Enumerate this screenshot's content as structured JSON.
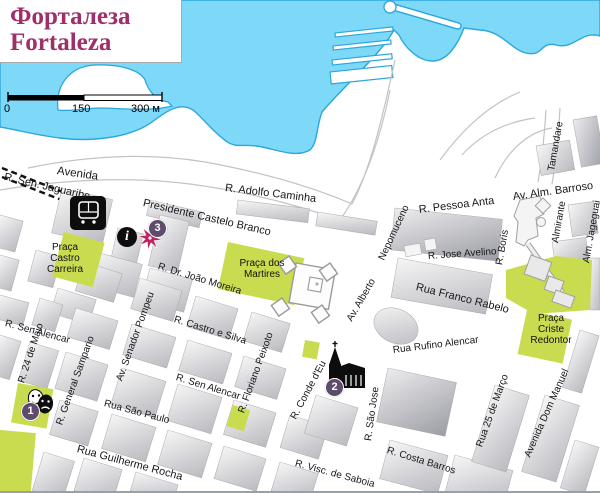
{
  "title": {
    "line1": "Форталеза",
    "line2": "Fortaleza"
  },
  "scale_bar": {
    "zero": "0",
    "mid": "150",
    "end": "300 м"
  },
  "colors": {
    "water": "#7ed8f7",
    "coast": "#2ba7dd",
    "park": "#c9db4f",
    "title_text": "#9e2f6b",
    "marker": "#5d4c6b",
    "star": "#c02563"
  },
  "info_icon_glyph": "i",
  "markers": [
    {
      "label": "1"
    },
    {
      "label": "2"
    },
    {
      "label": "3"
    }
  ],
  "streets": [
    {
      "label": "Avenida"
    },
    {
      "label": "R. Sen. Jaguaribe"
    },
    {
      "label": "Presidente Castelo Branco"
    },
    {
      "label": "R. Adolfo Caminha"
    },
    {
      "label": "R. Pessoa Anta"
    },
    {
      "label": "Av. Alm. Barroso"
    },
    {
      "label": "Tamandare"
    },
    {
      "label": "Almirante"
    },
    {
      "label": "Alm. Jageguai"
    },
    {
      "label": "R. Boris"
    },
    {
      "label": "R. Jose Avelino"
    },
    {
      "label": "Rua Franco Rabelo"
    },
    {
      "label": "Nepomuceno"
    },
    {
      "label": "R. Dr. João Moreira"
    },
    {
      "label": "R. Castro e Silva"
    },
    {
      "label": "R. Sen Alencar"
    },
    {
      "label": "R. Sen Alencar"
    },
    {
      "label": "Av. Alberto"
    },
    {
      "label": "Rua Rufino Alencar"
    },
    {
      "label": "R. 24 de Maio"
    },
    {
      "label": "R. General Sampario"
    },
    {
      "label": "Av. Senador Pompeu"
    },
    {
      "label": "R. Floriano Peixoto"
    },
    {
      "label": "R. Conde d'Eu"
    },
    {
      "label": "R. São Jose"
    },
    {
      "label": "Rua São Paulo"
    },
    {
      "label": "Rua Guilherme Rocha"
    },
    {
      "label": "R. Visc. de Saboia"
    },
    {
      "label": "R. Costa Barros"
    },
    {
      "label": "Rua 25 de Março"
    },
    {
      "label": "Avenida Dom Manuel"
    }
  ],
  "parks": [
    {
      "lines": [
        "Praça",
        "Castro",
        "Carreira"
      ]
    },
    {
      "lines": [
        "Praça dos",
        "Martires"
      ]
    },
    {
      "lines": [
        "Praça",
        "Criste",
        "Redontor"
      ]
    }
  ]
}
